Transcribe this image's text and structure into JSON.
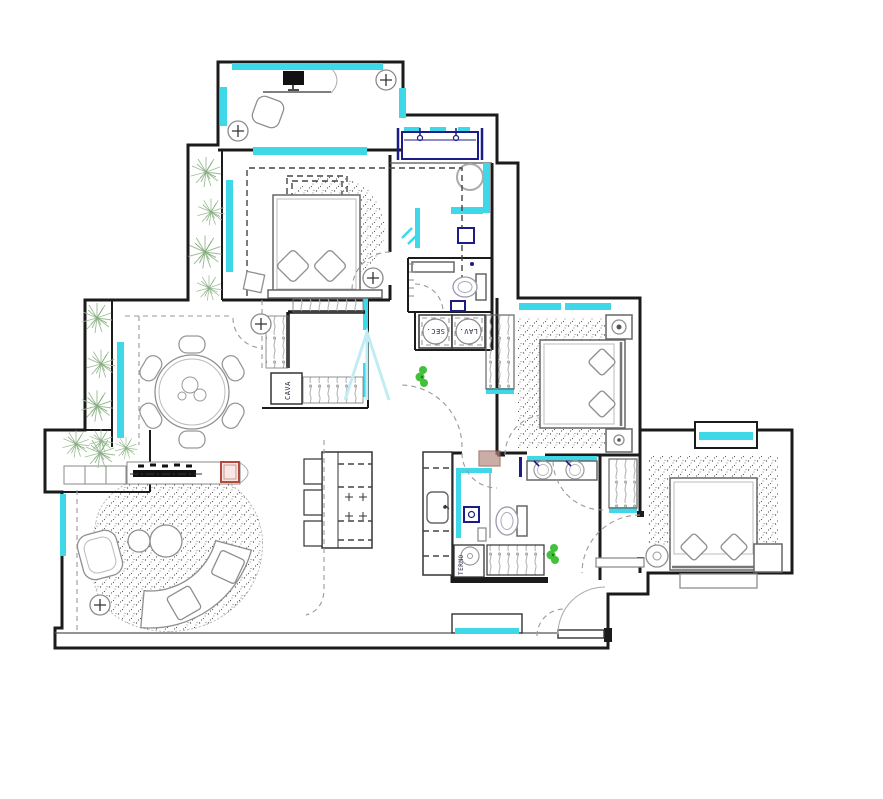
{
  "meta": {
    "type": "apartment-floor-plan"
  },
  "labels": {
    "dryer": "SEC.",
    "washer": "LAV.",
    "wine_cellar": "CAVA",
    "water_heater": "TERMO"
  },
  "icons": {
    "column_marker": "plus-in-circle",
    "plant": "radial-shrub-burst",
    "cooktop_burner": "plus-cross",
    "fireplace": "black-log-bar"
  },
  "colors": {
    "wall": "#1b1b1b",
    "window": "#3fd8e8",
    "navy": "#1b1c86",
    "plant": "#9cbd95",
    "accent_green": "#43c13b",
    "accent_red": "#b5493b",
    "accent_red_fill": "#f7e8e6",
    "brown": "#b58b82",
    "furniture": "#8f8f8f",
    "rug_dot": "#5a5a5a",
    "arrow_light": "#c2ecf3"
  }
}
